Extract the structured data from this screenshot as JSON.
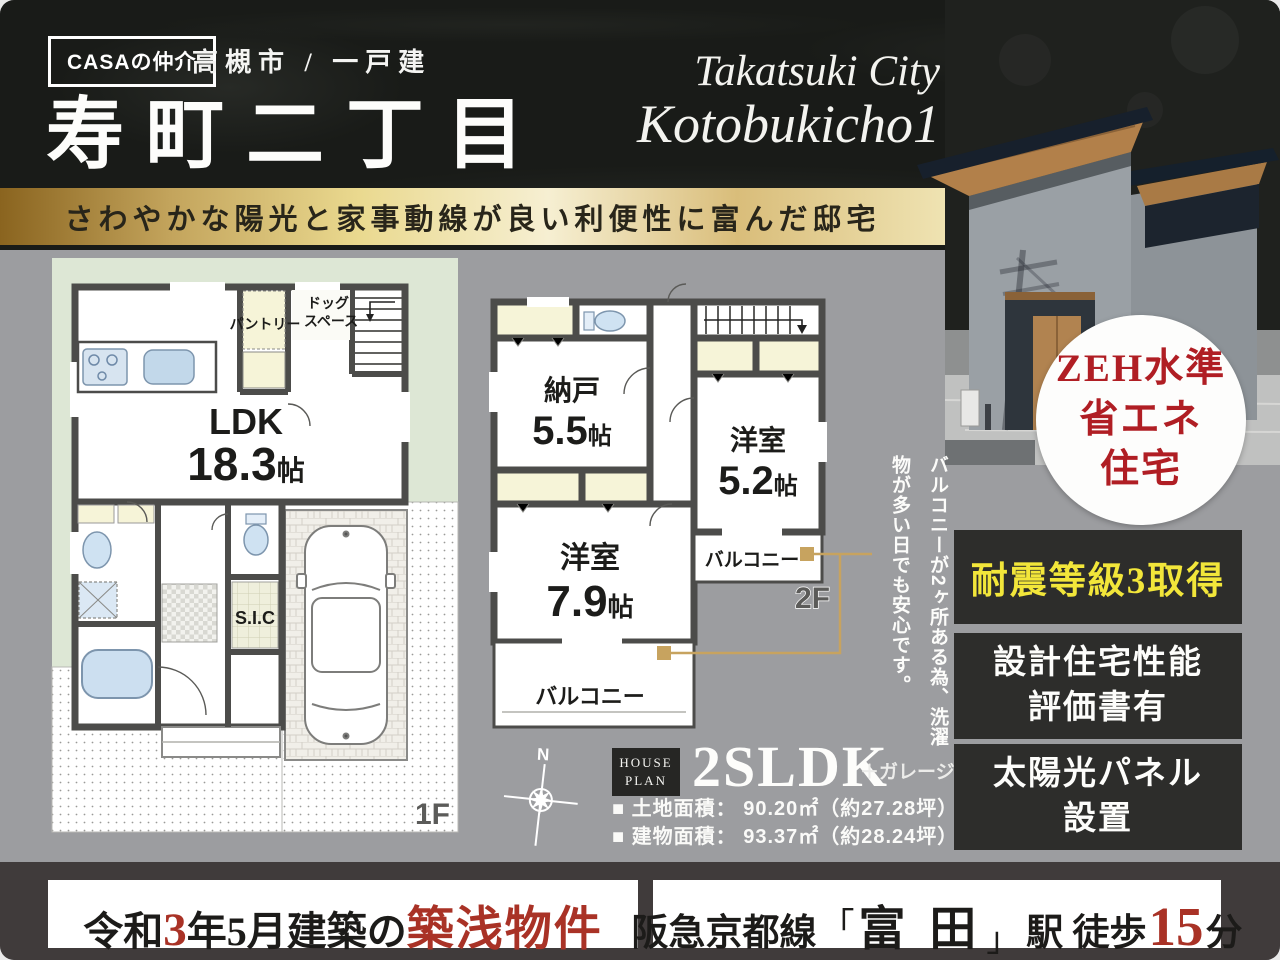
{
  "header": {
    "logo": "CASAの仲介",
    "area": "高槻市 / 一戸建",
    "title": "寿町二丁目",
    "script1": "Takatsuki City",
    "script2": "Kotobukicho1"
  },
  "catchphrase": "さわやかな陽光と家事動線が良い利便性に富んだ邸宅",
  "plan1f": {
    "floor": "1F",
    "ldk_name": "LDK",
    "ldk_num": "18.3",
    "ldk_unit": "帖",
    "pantry": "パントリー",
    "dog1": "ドッグ",
    "dog2": "スペース",
    "sic": "S.I.C"
  },
  "plan2f": {
    "floor": "2F",
    "storage_name": "納戸",
    "storage_num": "5.5",
    "storage_unit": "帖",
    "room1_name": "洋室",
    "room1_num": "5.2",
    "room1_unit": "帖",
    "room2_name": "洋室",
    "room2_num": "7.9",
    "room2_unit": "帖",
    "balcony_right": "バルコニー",
    "balcony_bottom": "バルコニー"
  },
  "annotation": "バルコニーが2ヶ所ある為、洗濯物が多い日でも安心です。",
  "compass": "N",
  "zeh": {
    "line1": "ZEH水準",
    "line2": "省エネ",
    "line3": "住宅"
  },
  "badges": {
    "b1": "耐震等級3取得",
    "b2a": "設計住宅性能",
    "b2b": "評価書有",
    "b3a": "太陽光パネル",
    "b3b": "設置"
  },
  "houseplan": {
    "tag1": "HOUSE",
    "tag2": "PLAN",
    "type": "2SLDK",
    "suffix": "＋ガレージ",
    "land": "■ 土地面積： 90.20㎡（約27.28坪）",
    "building": "■ 建物面積： 93.37㎡（約28.24坪）"
  },
  "footer": {
    "left": {
      "s1": "令和",
      "s2": "3",
      "s3": "年5月建築の",
      "s4": "築浅物件"
    },
    "right": {
      "s1": "阪急京都線",
      "s2": "「",
      "s3": "富 田",
      "s4": "」",
      "s5": "駅 徒歩",
      "s6": "15",
      "s7": "分"
    }
  },
  "colors": {
    "accent_red": "#a93226",
    "zeh_red": "#b01e24",
    "accent_yellow": "#f2e63a",
    "gold_line": "#c7a35f",
    "wall": "#4c4c4a",
    "lot_green": "#dde7d5"
  }
}
